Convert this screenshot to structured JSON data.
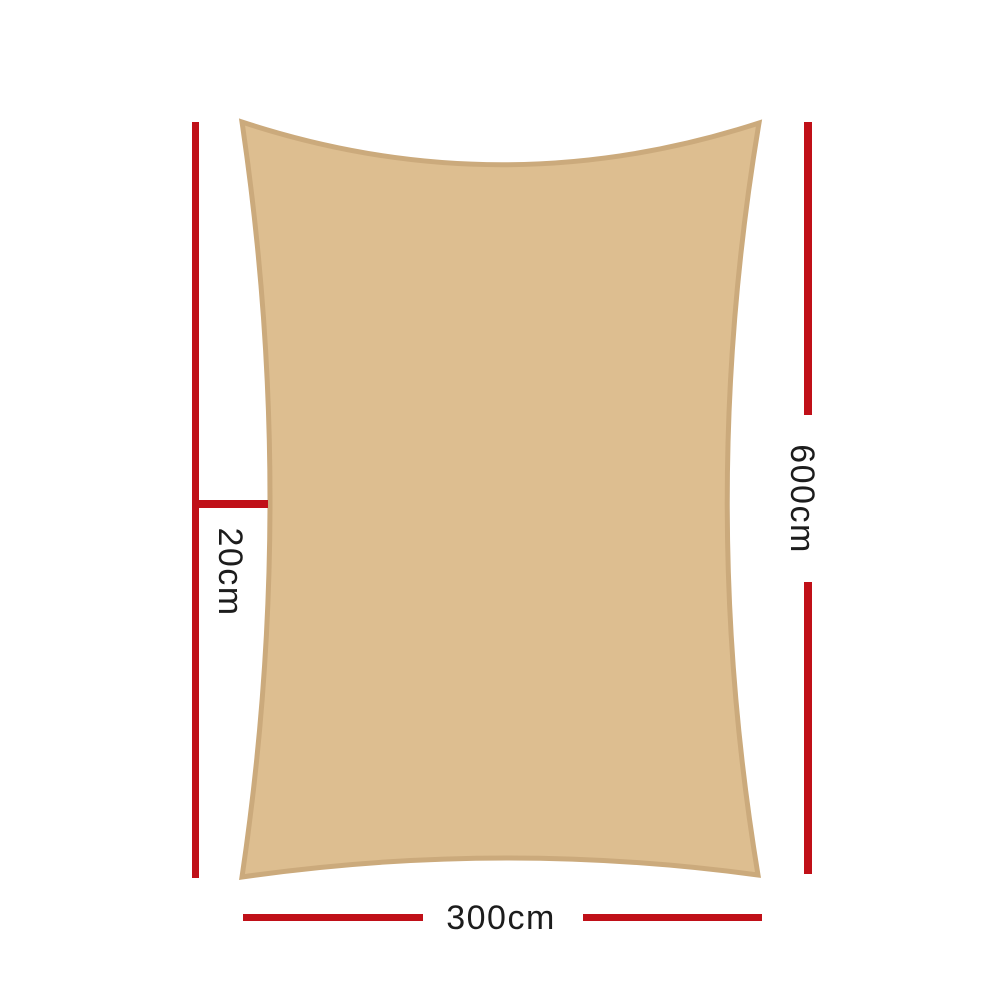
{
  "diagram": {
    "dimensions": {
      "vertical": "600cm",
      "horizontal": "300cm",
      "offset": "20cm"
    }
  },
  "colors": {
    "sail_fill": "#ddbe90",
    "sail_border": "#cbaa7c",
    "dimension_line": "#c01018",
    "label_text": "#1c1c1c"
  }
}
